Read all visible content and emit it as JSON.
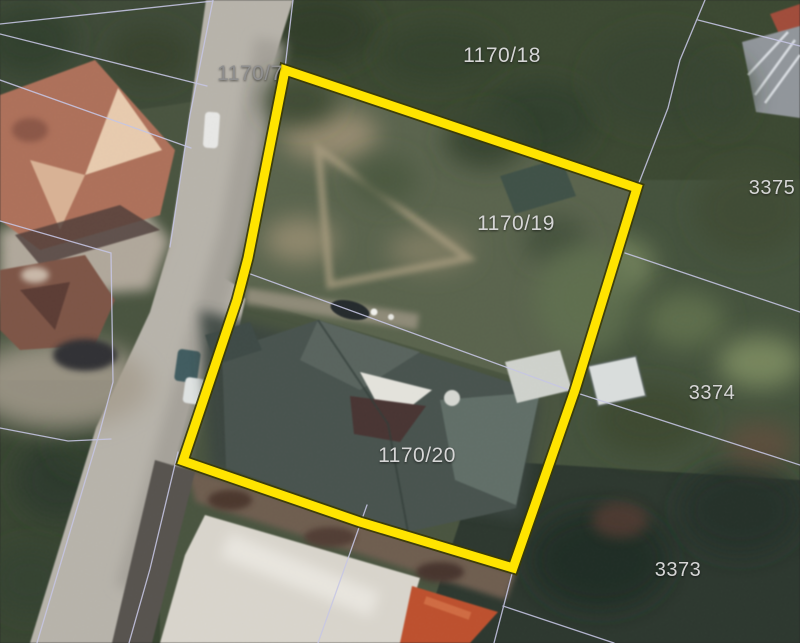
{
  "map": {
    "highlight": {
      "color": "#ffe400",
      "outline_color": "#3a3a05",
      "points": "285,70 637,188 575,390 513,568 360,522 183,461 237,300 248,258"
    },
    "cadastral": {
      "line_color": "#c6c6e4",
      "lines": [
        "213,0 190,115 170,247",
        "293,0 285,68",
        "0,24 213,1",
        "0,34 207,86",
        "0,80 191,148",
        "0,221 111,253 113,382 100,431 37,643",
        "0,428 68,441 111,439",
        "178,452 150,569 129,643",
        "367,505 318,643",
        "513,570 494,643",
        "503,606 614,643",
        "637,188 668,108 680,60 705,0",
        "698,20 800,46",
        "625,253 800,312",
        "245,272 577,393 800,465"
      ]
    },
    "labels": [
      {
        "text": "1170/7",
        "x": 250,
        "y": 80,
        "size": 21,
        "color": "#8f8f8f"
      },
      {
        "text": "1170/18",
        "x": 502,
        "y": 62,
        "size": 21,
        "color": "#d6d6d6"
      },
      {
        "text": "1170/19",
        "x": 516,
        "y": 230,
        "size": 21,
        "color": "#d6d6d6"
      },
      {
        "text": "1170/20",
        "x": 417,
        "y": 462,
        "size": 21,
        "color": "#d6d6d6"
      },
      {
        "text": "3375",
        "x": 772,
        "y": 194,
        "size": 20,
        "color": "#d6d6d6"
      },
      {
        "text": "3374",
        "x": 712,
        "y": 399,
        "size": 20,
        "color": "#d6d6d6"
      },
      {
        "text": "3373",
        "x": 678,
        "y": 576,
        "size": 20,
        "color": "#d6d6d6"
      }
    ]
  }
}
